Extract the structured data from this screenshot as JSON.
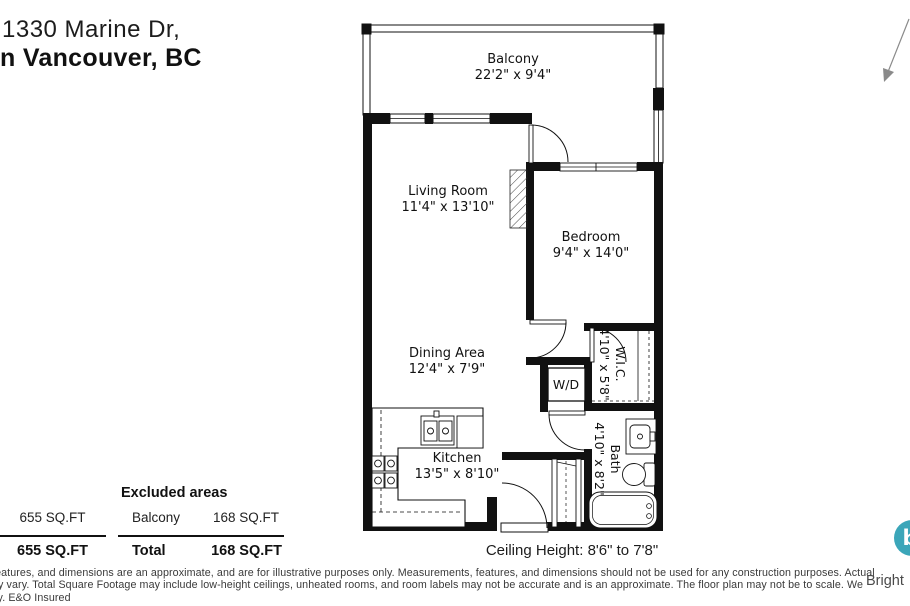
{
  "header": {
    "address_line1": "1330 Marine Dr,",
    "address_line2": "n Vancouver, BC"
  },
  "plan_labels": {
    "balcony": {
      "name": "Balcony",
      "dims": "22'2\" x 9'4\""
    },
    "living_room": {
      "name": "Living Room",
      "dims": "11'4\" x 13'10\""
    },
    "bedroom": {
      "name": "Bedroom",
      "dims": "9'4\" x 14'0\""
    },
    "dining": {
      "name": "Dining Area",
      "dims": "12'4\" x 7'9\""
    },
    "kitchen": {
      "name": "Kitchen",
      "dims": "13'5\" x 8'10\""
    },
    "wic": {
      "name": "W.I.C.",
      "dims": "4'10\" x 5'8\""
    },
    "bath": {
      "name": "Bath",
      "dims": "4'10\" x 8'2\""
    },
    "washer_dryer": {
      "label": "W/D"
    }
  },
  "area_table": {
    "main_area": "655 SQ.FT",
    "main_total": "655 SQ.FT",
    "excluded_header": "Excluded areas",
    "excluded_row_label": "Balcony",
    "excluded_row_value": "168 SQ.FT",
    "total_label": "Total",
    "total_value": "168 SQ.FT"
  },
  "footer": {
    "ceiling_height": "Ceiling Height: 8'6\" to 7'8\"",
    "disclaimer_line1": "features, and dimensions are an approximate, and are for illustrative purposes only. Measurements, features, and dimensions should not be used for any construction purposes. Actual",
    "disclaimer_line2": "ay vary. Total Square Footage may include low-height ceilings, unheated rooms, and room labels may not be accurate and is an approximate. The floor plan may not be to scale. We",
    "disclaimer_line3": "ity. E&O Insured",
    "brand_text": "Bright",
    "brand_initial": "b",
    "brand_color": "#3ba6b9"
  }
}
